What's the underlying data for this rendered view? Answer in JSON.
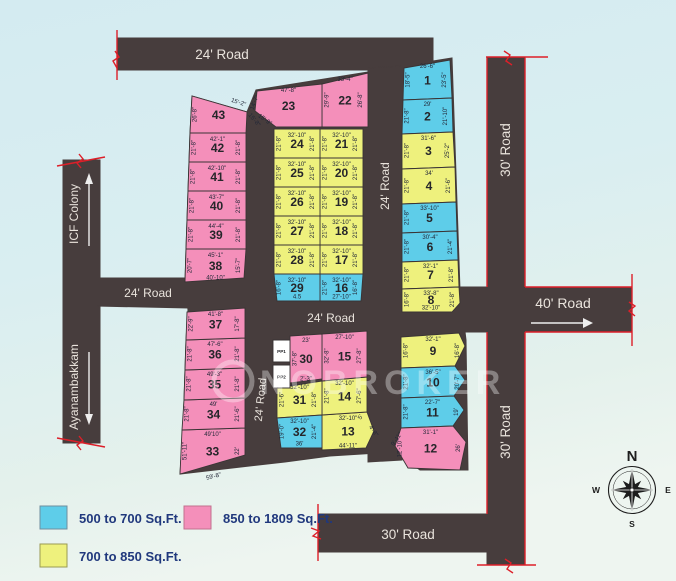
{
  "colors": {
    "blue": "#5ecde9",
    "pink": "#f48fba",
    "yellow": "#eef17d",
    "white": "#ffffff",
    "road": "#473d3d",
    "red": "#dd1f29",
    "stroke": "#3a3435"
  },
  "roads": {
    "labels": [
      {
        "text": "24' Road"
      },
      {
        "text": "24' Road"
      },
      {
        "text": "24' Road"
      },
      {
        "text": "24' Road"
      },
      {
        "text": "24' Road"
      },
      {
        "text": "30' Road"
      },
      {
        "text": "30' Road"
      },
      {
        "text": "40' Road"
      },
      {
        "text": "30' Road"
      }
    ]
  },
  "side_labels": {
    "icf": "ICF Colony",
    "ayanambakkam": "Ayanambakkam"
  },
  "legend": {
    "items": [
      {
        "label": "500 to 700 Sq.Ft.",
        "color": "#5ecde9"
      },
      {
        "label": "850 to 1809 Sq.Ft.",
        "color": "#f48fba"
      },
      {
        "label": "700 to 850 Sq.Ft.",
        "color": "#eef17d"
      }
    ]
  },
  "compass": {
    "n": "N",
    "e": "E",
    "s": "S",
    "w": "W"
  },
  "watermark": {
    "text": "NOBROKER"
  },
  "plots": [
    {
      "n": "1",
      "c": "blue",
      "poly": [
        [
          404,
          68
        ],
        [
          450,
          60
        ],
        [
          452,
          98
        ],
        [
          403,
          100
        ]
      ],
      "top": "26'-6\"",
      "left": "18'-5\"",
      "right": "23'-5\""
    },
    {
      "n": "2",
      "c": "blue",
      "poly": [
        [
          403,
          100
        ],
        [
          452,
          98
        ],
        [
          453,
          132
        ],
        [
          402,
          134
        ]
      ],
      "top": "29'",
      "left": "21'-8\"",
      "right": "21'-10\""
    },
    {
      "n": "3",
      "c": "yellow",
      "poly": [
        [
          402,
          134
        ],
        [
          453,
          132
        ],
        [
          455,
          167
        ],
        [
          402,
          169
        ]
      ],
      "top": "31'-6\"",
      "left": "21'-8\"",
      "right": "25'-2\""
    },
    {
      "n": "4",
      "c": "yellow",
      "poly": [
        [
          402,
          169
        ],
        [
          455,
          167
        ],
        [
          456,
          202
        ],
        [
          402,
          204
        ]
      ],
      "top": "34'",
      "left": "21'-8\"",
      "right": "21'-6\""
    },
    {
      "n": "5",
      "c": "blue",
      "poly": [
        [
          402,
          204
        ],
        [
          456,
          202
        ],
        [
          457,
          231
        ],
        [
          402,
          233
        ]
      ],
      "top": "33'-10\"",
      "left": "21'-8\""
    },
    {
      "n": "6",
      "c": "blue",
      "poly": [
        [
          402,
          233
        ],
        [
          457,
          231
        ],
        [
          458,
          260
        ],
        [
          402,
          262
        ]
      ],
      "top": "30'-4\"",
      "left": "21'-8\"",
      "right": "21'-4\""
    },
    {
      "n": "7",
      "c": "yellow",
      "poly": [
        [
          402,
          262
        ],
        [
          458,
          260
        ],
        [
          459,
          287
        ],
        [
          402,
          289
        ]
      ],
      "top": "32'-1\"",
      "left": "21'-8\"",
      "right": "21'-8\""
    },
    {
      "n": "8",
      "c": "yellow",
      "poly": [
        [
          402,
          289
        ],
        [
          459,
          287
        ],
        [
          460,
          303
        ],
        [
          452,
          312
        ],
        [
          402,
          312
        ]
      ],
      "top": "33'-8\"",
      "left": "16'-8\"",
      "right": "21'-8\"",
      "bottom": "32'-10\""
    },
    {
      "n": "9",
      "c": "yellow",
      "poly": [
        [
          401,
          337
        ],
        [
          459,
          333
        ],
        [
          465,
          346
        ],
        [
          455,
          366
        ],
        [
          401,
          368
        ]
      ],
      "top": "32'-1\"",
      "left": "16'-8\"",
      "right": "16'-8\""
    },
    {
      "n": "10",
      "c": "blue",
      "poly": [
        [
          401,
          368
        ],
        [
          455,
          366
        ],
        [
          465,
          380
        ],
        [
          454,
          396
        ],
        [
          401,
          398
        ]
      ],
      "top": "36'-5\"",
      "left": "21'-8\"",
      "right": "20'-7\""
    },
    {
      "n": "11",
      "c": "blue",
      "poly": [
        [
          401,
          398
        ],
        [
          454,
          396
        ],
        [
          464,
          410
        ],
        [
          453,
          426
        ],
        [
          401,
          428
        ]
      ],
      "top": "22'-7\"",
      "left": "21'-8\"",
      "right": "19'"
    },
    {
      "n": "12",
      "c": "pink",
      "poly": [
        [
          401,
          428
        ],
        [
          453,
          426
        ],
        [
          466,
          442
        ],
        [
          460,
          470
        ],
        [
          408,
          468
        ],
        [
          395,
          446
        ]
      ],
      "top": "31'-1\"",
      "left": "12'-10\"",
      "right": "26'",
      "extra": [
        {
          "t": "9'-11\"",
          "x": 398,
          "y": 440,
          "r": -55
        }
      ]
    },
    {
      "n": "13",
      "c": "yellow",
      "poly": [
        [
          322,
          415
        ],
        [
          367,
          412
        ],
        [
          374,
          431
        ],
        [
          366,
          448
        ],
        [
          322,
          450
        ]
      ],
      "top": "32'-10\"",
      "bottom": "44'-11\"",
      "extra": [
        {
          "t": "5'",
          "x": 362,
          "y": 418,
          "r": -60
        },
        {
          "t": "4'-8\"",
          "x": 372,
          "y": 432,
          "r": 55
        }
      ]
    },
    {
      "n": "14",
      "c": "yellow",
      "poly": [
        [
          322,
          381
        ],
        [
          367,
          377
        ],
        [
          367,
          412
        ],
        [
          322,
          415
        ]
      ],
      "top": "32'-10\"",
      "left": "21'-8\"",
      "right": "27'-6\""
    },
    {
      "n": "15",
      "c": "pink",
      "poly": [
        [
          322,
          334
        ],
        [
          367,
          331
        ],
        [
          367,
          377
        ],
        [
          322,
          381
        ]
      ],
      "top": "27'-10\"",
      "left": "32'-8\"",
      "right": "27'-8\""
    },
    {
      "n": "16",
      "c": "blue",
      "poly": [
        [
          320,
          274
        ],
        [
          363,
          274
        ],
        [
          361,
          301
        ],
        [
          320,
          301
        ]
      ],
      "top": "32'-10\"",
      "left": "21'-8\"",
      "right": "16'-8\"",
      "bottom": "27'-10\""
    },
    {
      "n": "17",
      "c": "yellow",
      "poly": [
        [
          320,
          245
        ],
        [
          363,
          245
        ],
        [
          363,
          274
        ],
        [
          320,
          274
        ]
      ],
      "top": "32'-10\"",
      "left": "21'-8\"",
      "right": "21'-8\""
    },
    {
      "n": "18",
      "c": "yellow",
      "poly": [
        [
          320,
          216
        ],
        [
          363,
          216
        ],
        [
          363,
          245
        ],
        [
          320,
          245
        ]
      ],
      "top": "32'-10\"",
      "left": "21'-8\"",
      "right": "21'-8\""
    },
    {
      "n": "19",
      "c": "yellow",
      "poly": [
        [
          320,
          187
        ],
        [
          363,
          187
        ],
        [
          363,
          216
        ],
        [
          320,
          216
        ]
      ],
      "top": "32'-10\"",
      "left": "21'-8\"",
      "right": "21'-8\""
    },
    {
      "n": "20",
      "c": "yellow",
      "poly": [
        [
          320,
          158
        ],
        [
          363,
          158
        ],
        [
          363,
          187
        ],
        [
          320,
          187
        ]
      ],
      "top": "32'-10\"",
      "left": "21'-8\"",
      "right": "21'-8\""
    },
    {
      "n": "21",
      "c": "yellow",
      "poly": [
        [
          320,
          129
        ],
        [
          363,
          129
        ],
        [
          363,
          158
        ],
        [
          320,
          158
        ]
      ],
      "top": "32'-10\"",
      "left": "21'-8\"",
      "right": "21'-8\""
    },
    {
      "n": "22",
      "c": "pink",
      "poly": [
        [
          322,
          84
        ],
        [
          368,
          73
        ],
        [
          368,
          127
        ],
        [
          322,
          127
        ]
      ],
      "top": "33'-4\"",
      "left": "29'-9\"",
      "right": "26'-8\""
    },
    {
      "n": "23",
      "c": "pink",
      "poly": [
        [
          257,
          91
        ],
        [
          322,
          84
        ],
        [
          322,
          127
        ],
        [
          276,
          127
        ],
        [
          255,
          111
        ]
      ],
      "top": "47'-8\"",
      "extra": [
        {
          "t": "14'-7\"",
          "x": 256,
          "y": 103,
          "r": -70
        },
        {
          "t": "15'-9\"",
          "x": 264,
          "y": 121,
          "r": 35
        }
      ]
    },
    {
      "n": "24",
      "c": "yellow",
      "poly": [
        [
          274,
          129
        ],
        [
          320,
          129
        ],
        [
          320,
          158
        ],
        [
          274,
          158
        ]
      ],
      "top": "32'-10\"",
      "left": "21'-8\"",
      "right": "21'-8\""
    },
    {
      "n": "25",
      "c": "yellow",
      "poly": [
        [
          274,
          158
        ],
        [
          320,
          158
        ],
        [
          320,
          187
        ],
        [
          274,
          187
        ]
      ],
      "top": "32'-10\"",
      "left": "21'-8\"",
      "right": "21'-8\""
    },
    {
      "n": "26",
      "c": "yellow",
      "poly": [
        [
          274,
          187
        ],
        [
          320,
          187
        ],
        [
          320,
          216
        ],
        [
          274,
          216
        ]
      ],
      "top": "32'-10\"",
      "left": "21'-8\"",
      "right": "21'-8\""
    },
    {
      "n": "27",
      "c": "yellow",
      "poly": [
        [
          274,
          216
        ],
        [
          320,
          216
        ],
        [
          320,
          245
        ],
        [
          274,
          245
        ]
      ],
      "top": "32'-10\"",
      "left": "21'-8\"",
      "right": "21'-8\""
    },
    {
      "n": "28",
      "c": "yellow",
      "poly": [
        [
          274,
          245
        ],
        [
          320,
          245
        ],
        [
          320,
          274
        ],
        [
          274,
          274
        ]
      ],
      "top": "32'-10\"",
      "left": "21'-8\"",
      "right": "21'-8\""
    },
    {
      "n": "29",
      "c": "blue",
      "poly": [
        [
          274,
          274
        ],
        [
          320,
          274
        ],
        [
          320,
          301
        ],
        [
          277,
          301
        ]
      ],
      "top": "32'-10\"",
      "left": "16'-8\"",
      "bottom": "4.5"
    },
    {
      "n": "30",
      "c": "pink",
      "poly": [
        [
          290,
          336
        ],
        [
          322,
          334
        ],
        [
          322,
          379
        ],
        [
          290,
          383
        ]
      ],
      "top": "23'",
      "left": "37'-8\"",
      "bottom": "2'-3\""
    },
    {
      "n": "31",
      "c": "yellow",
      "poly": [
        [
          277,
          388
        ],
        [
          322,
          381
        ],
        [
          322,
          415
        ],
        [
          277,
          418
        ]
      ],
      "top": "32'-10\"",
      "left": "21'-6\"",
      "right": "21'-8\""
    },
    {
      "n": "32",
      "c": "blue",
      "poly": [
        [
          277,
          418
        ],
        [
          322,
          415
        ],
        [
          322,
          448
        ],
        [
          281,
          448
        ]
      ],
      "top": "32'-10\"",
      "left": "19'-0\"",
      "right": "21'-4\"",
      "bottom": "36'"
    },
    {
      "n": "33",
      "c": "pink",
      "poly": [
        [
          182,
          430
        ],
        [
          245,
          428
        ],
        [
          245,
          455
        ],
        [
          180,
          474
        ]
      ],
      "top": "49'10\"",
      "left": "51'-11\"",
      "right": "22'",
      "extra": [
        {
          "t": "59'-8\"",
          "x": 214,
          "y": 478,
          "r": -14
        }
      ]
    },
    {
      "n": "34",
      "c": "pink",
      "poly": [
        [
          184,
          400
        ],
        [
          245,
          398
        ],
        [
          245,
          428
        ],
        [
          182,
          430
        ]
      ],
      "top": "49'",
      "left": "21'-8\"",
      "right": "21'-6\""
    },
    {
      "n": "35",
      "c": "pink",
      "poly": [
        [
          185,
          370
        ],
        [
          245,
          368
        ],
        [
          245,
          398
        ],
        [
          184,
          400
        ]
      ],
      "top": "49'-3\"",
      "left": "21'-8\"",
      "right": "21'-8\""
    },
    {
      "n": "36",
      "c": "pink",
      "poly": [
        [
          186,
          340
        ],
        [
          245,
          338
        ],
        [
          245,
          368
        ],
        [
          185,
          370
        ]
      ],
      "top": "47'-6\"",
      "left": "21'-8\"",
      "right": "21'-8\""
    },
    {
      "n": "37",
      "c": "pink",
      "poly": [
        [
          187,
          312
        ],
        [
          245,
          308
        ],
        [
          245,
          338
        ],
        [
          186,
          340
        ]
      ],
      "top": "41'-8\"",
      "left": "22'-9\"",
      "right": "17'-8\""
    },
    {
      "n": "38",
      "c": "pink",
      "poly": [
        [
          186,
          249
        ],
        [
          246,
          249
        ],
        [
          244,
          278
        ],
        [
          185,
          282
        ]
      ],
      "top": "45'-1\"",
      "left": "20'-7\"",
      "right": "15'-7\"",
      "bottom": "40'-10\""
    },
    {
      "n": "39",
      "c": "pink",
      "poly": [
        [
          187,
          220
        ],
        [
          246,
          220
        ],
        [
          246,
          249
        ],
        [
          186,
          249
        ]
      ],
      "top": "44'-4\"",
      "left": "21'-8\"",
      "right": "21'-8\""
    },
    {
      "n": "40",
      "c": "pink",
      "poly": [
        [
          188,
          191
        ],
        [
          246,
          191
        ],
        [
          246,
          220
        ],
        [
          187,
          220
        ]
      ],
      "top": "43'-7\"",
      "left": "21'-8\"",
      "right": "21'-8\""
    },
    {
      "n": "41",
      "c": "pink",
      "poly": [
        [
          189,
          162
        ],
        [
          246,
          162
        ],
        [
          246,
          191
        ],
        [
          188,
          191
        ]
      ],
      "top": "42'-10\"",
      "left": "21'-8\"",
      "right": "21'-8\""
    },
    {
      "n": "42",
      "c": "pink",
      "poly": [
        [
          190,
          133
        ],
        [
          246,
          133
        ],
        [
          246,
          162
        ],
        [
          189,
          162
        ]
      ],
      "top": "42'-1\"",
      "left": "21'-8\"",
      "right": "21'-8\""
    },
    {
      "n": "43",
      "c": "pink",
      "poly": [
        [
          192,
          96
        ],
        [
          247,
          112
        ],
        [
          246,
          133
        ],
        [
          190,
          133
        ]
      ],
      "left": "26'-8\"",
      "extra": [
        {
          "t": "15'-2\"",
          "x": 238,
          "y": 104,
          "r": 18
        },
        {
          "t": "15'-8\"",
          "x": 253,
          "y": 121,
          "r": 50
        }
      ]
    },
    {
      "n": "PP1",
      "c": "white",
      "poly": [
        [
          273,
          340
        ],
        [
          290,
          340
        ],
        [
          290,
          362
        ],
        [
          273,
          362
        ]
      ]
    },
    {
      "n": "PP2",
      "c": "white",
      "poly": [
        [
          273,
          365
        ],
        [
          290,
          365
        ],
        [
          290,
          388
        ],
        [
          273,
          388
        ]
      ]
    }
  ]
}
